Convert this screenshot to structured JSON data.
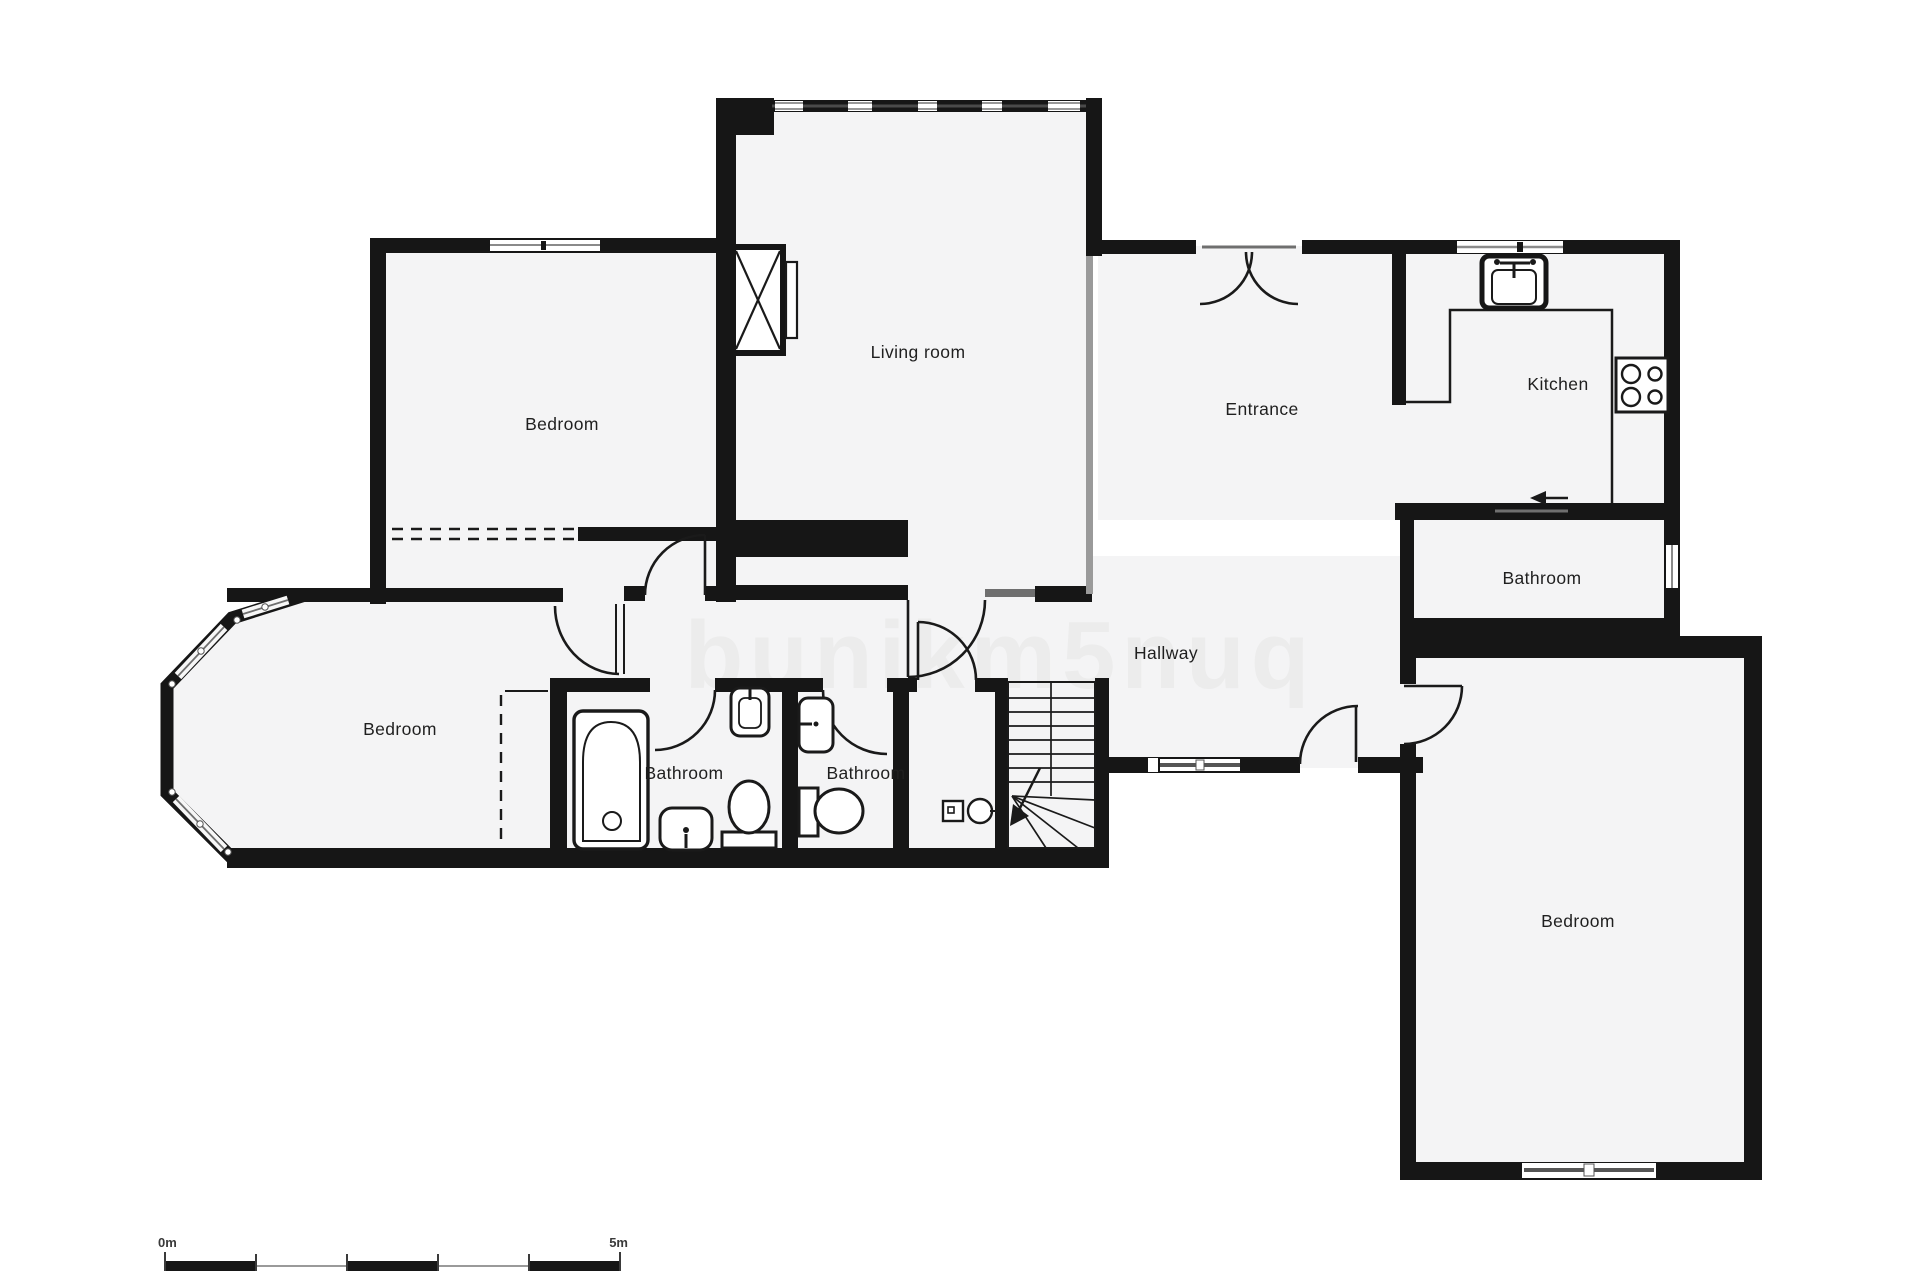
{
  "page": {
    "title": "Apartment floor plan",
    "background": "#ffffff",
    "wall_color": "#161616",
    "room_fill": "#f4f4f5",
    "line_color": "#1a1a1a",
    "window_color": "#8a8a8a"
  },
  "watermark": {
    "text": "bunikm5nuq"
  },
  "rooms": [
    {
      "id": "bedroom-top-left",
      "label": "Bedroom"
    },
    {
      "id": "living-room",
      "label": "Living room"
    },
    {
      "id": "entrance",
      "label": "Entrance"
    },
    {
      "id": "kitchen",
      "label": "Kitchen"
    },
    {
      "id": "bathroom-right",
      "label": "Bathroom"
    },
    {
      "id": "hallway",
      "label": "Hallway"
    },
    {
      "id": "bedroom-left",
      "label": "Bedroom"
    },
    {
      "id": "bathroom-1",
      "label": "Bathroom"
    },
    {
      "id": "bathroom-2",
      "label": "Bathroom"
    },
    {
      "id": "bedroom-bottom-right",
      "label": "Bedroom"
    }
  ],
  "fixtures": [
    "fireplace-flue",
    "kitchen-sink",
    "stove-4-burners",
    "kitchen-counter",
    "bathtub",
    "wall-sink",
    "pedestal-sink",
    "toilet",
    "toilet",
    "wall-sink",
    "washer",
    "dryer",
    "staircase-with-winders",
    "direction-arrow"
  ],
  "scale_bar": {
    "start_label": "0m",
    "end_label": "5m"
  }
}
